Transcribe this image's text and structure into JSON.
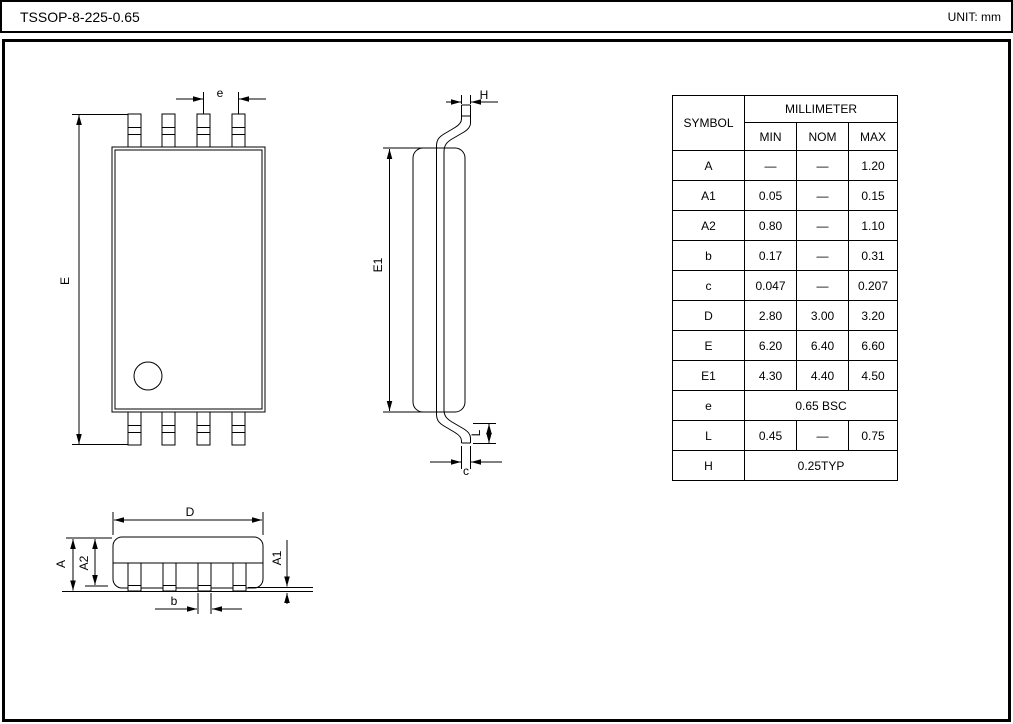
{
  "title": "TSSOP-8-225-0.65",
  "unit": "UNIT: mm",
  "table": {
    "symbol_header": "SYMBOL",
    "unit_header": "MILLIMETER",
    "col_headers": [
      "MIN",
      "NOM",
      "MAX"
    ],
    "rows": [
      {
        "symbol": "A",
        "min": "—",
        "nom": "—",
        "max": "1.20"
      },
      {
        "symbol": "A1",
        "min": "0.05",
        "nom": "—",
        "max": "0.15"
      },
      {
        "symbol": "A2",
        "min": "0.80",
        "nom": "—",
        "max": "1.10"
      },
      {
        "symbol": "b",
        "min": "0.17",
        "nom": "—",
        "max": "0.31"
      },
      {
        "symbol": "c",
        "min": "0.047",
        "nom": "—",
        "max": "0.207"
      },
      {
        "symbol": "D",
        "min": "2.80",
        "nom": "3.00",
        "max": "3.20"
      },
      {
        "symbol": "E",
        "min": "6.20",
        "nom": "6.40",
        "max": "6.60"
      },
      {
        "symbol": "E1",
        "min": "4.30",
        "nom": "4.40",
        "max": "4.50"
      },
      {
        "symbol": "e",
        "span": "0.65 BSC"
      },
      {
        "symbol": "L",
        "min": "0.45",
        "nom": "—",
        "max": "0.75"
      },
      {
        "symbol": "H",
        "span": "0.25TYP"
      }
    ]
  },
  "dim_labels": {
    "top_view": {
      "pitch": "e",
      "overall_width": "E"
    },
    "side_view": {
      "lead_tip": "H",
      "body_width": "E1",
      "foot_length": "L",
      "lead_thickness": "c"
    },
    "front_view": {
      "body_length": "D",
      "overall_height": "A",
      "body_thickness": "A2",
      "standoff": "A1",
      "lead_width": "b"
    }
  }
}
